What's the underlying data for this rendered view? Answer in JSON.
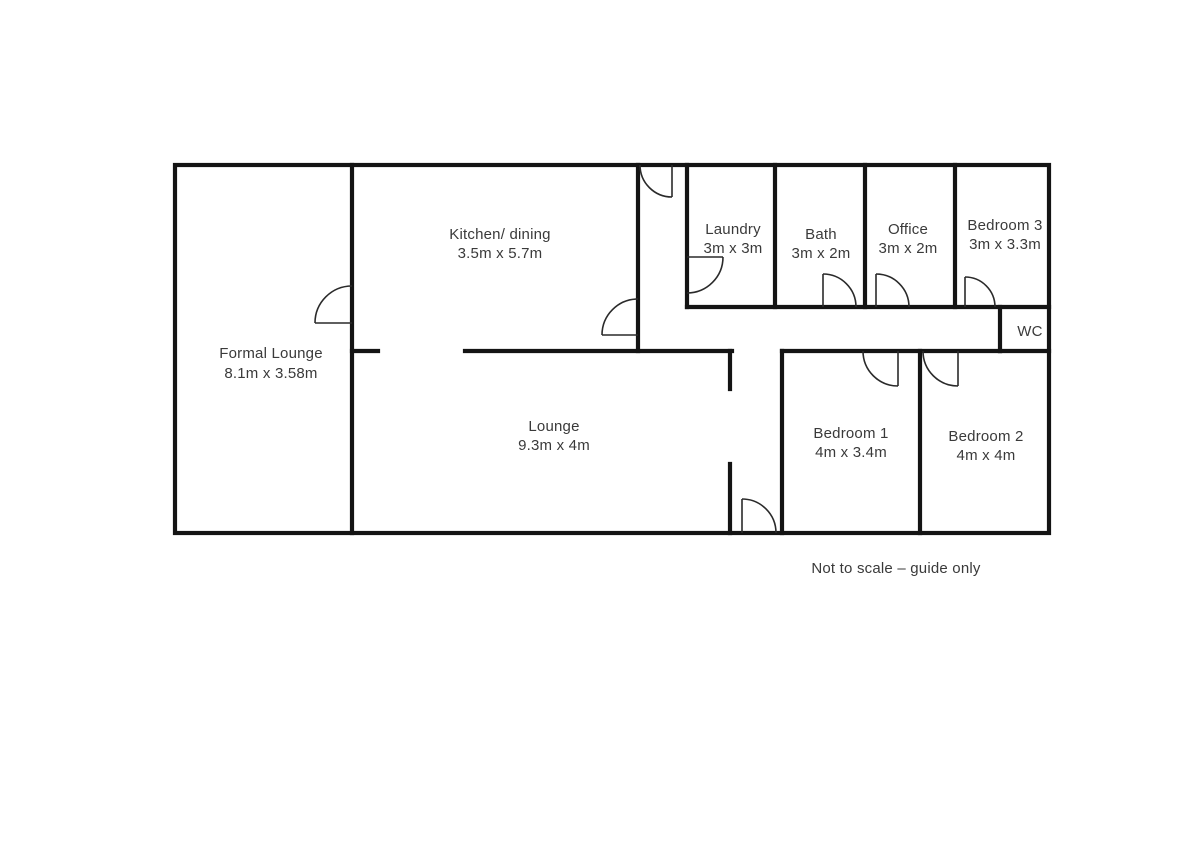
{
  "plan": {
    "wall_color": "#141414",
    "text_color": "#3a3a3a",
    "note": "Not to scale – guide only",
    "rooms": [
      {
        "id": "formal-lounge",
        "name": "Formal Lounge",
        "dims": "8.1m x 3.58m"
      },
      {
        "id": "kitchen-dining",
        "name": "Kitchen/ dining",
        "dims": "3.5m x 5.7m"
      },
      {
        "id": "laundry",
        "name": "Laundry",
        "dims": "3m x 3m"
      },
      {
        "id": "bath",
        "name": "Bath",
        "dims": "3m x 2m"
      },
      {
        "id": "office",
        "name": "Office",
        "dims": "3m x 2m"
      },
      {
        "id": "bedroom-3",
        "name": "Bedroom 3",
        "dims": "3m x 3.3m"
      },
      {
        "id": "wc",
        "name": "WC"
      },
      {
        "id": "lounge",
        "name": "Lounge",
        "dims": "9.3m x 4m"
      },
      {
        "id": "bedroom-1",
        "name": "Bedroom 1",
        "dims": "4m x 3.4m"
      },
      {
        "id": "bedroom-2",
        "name": "Bedroom 2",
        "dims": "4m x 4m"
      }
    ]
  }
}
